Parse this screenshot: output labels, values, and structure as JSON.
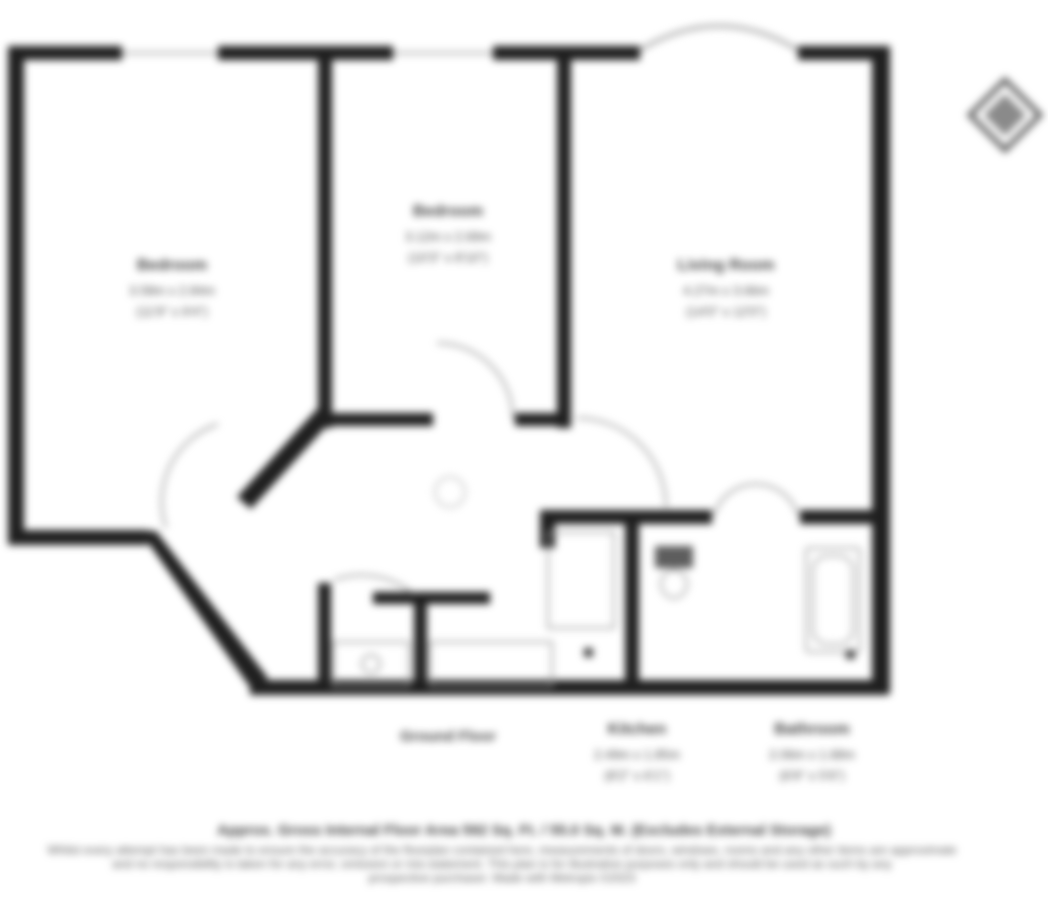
{
  "document": {
    "type": "residential-floorplan",
    "floor_caption": "Ground Floor"
  },
  "floorplan": {
    "rooms": [
      {
        "id": "bedroom-1",
        "name": "Bedroom",
        "metric": "3.58m x 2.84m",
        "imperial": "(11'9\" x 9'4\")"
      },
      {
        "id": "bedroom-2",
        "name": "Bedroom",
        "metric": "3.12m x 2.69m",
        "imperial": "(10'3\" x 8'10\")"
      },
      {
        "id": "living-room",
        "name": "Living Room",
        "metric": "4.27m x 3.66m",
        "imperial": "(14'0\" x 12'0\")"
      },
      {
        "id": "kitchen",
        "name": "Kitchen",
        "metric": "2.49m x 1.85m",
        "imperial": "(8'2\" x 6'1\")"
      },
      {
        "id": "bathroom",
        "name": "Bathroom",
        "metric": "2.06m x 1.68m",
        "imperial": "(6'9\" x 5'6\")"
      }
    ]
  },
  "footer": {
    "title": "Approx. Gross Internal Floor Area 592 Sq. Ft. / 55.0 Sq. M. (Excludes External Storage)",
    "lines": [
      "Whilst every attempt has been made to ensure the accuracy of the floorplan contained here, measurements of doors, windows, rooms and any other items are approximate",
      "and no responsibility is taken for any error, omission or mis-statement. This plan is for illustrative purposes only and should be used as such by any",
      "prospective purchaser. Made with Metropix ©2023"
    ]
  },
  "icons": {
    "compass": "compass-rose"
  },
  "colors": {
    "wall": "#1f1f1f",
    "door_arc": "#909090",
    "fixture": "#9e9e9e",
    "window": "#b5b5b5",
    "text": "#4c4c4c",
    "background": "#ffffff"
  }
}
